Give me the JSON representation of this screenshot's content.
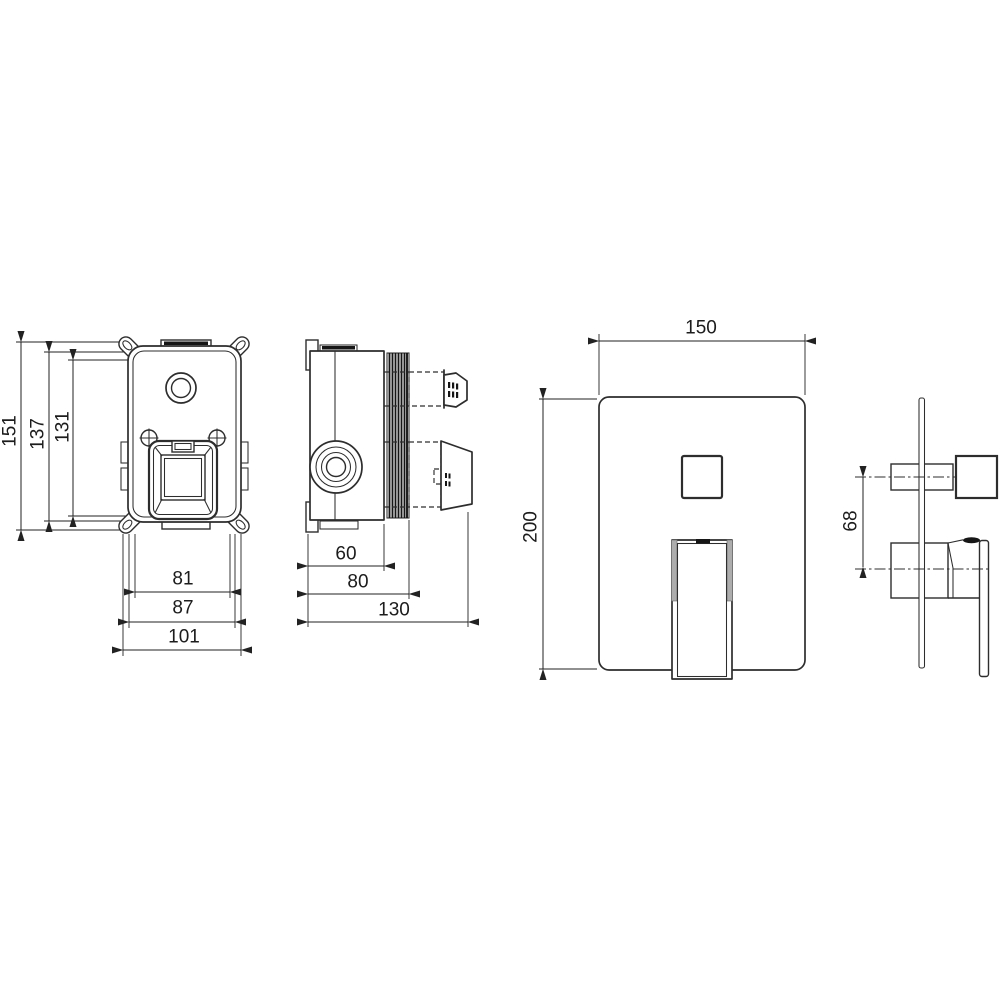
{
  "drawing": {
    "kind": "technical-dimension-drawing",
    "subject": "concealed shower mixer valve: rough-in box (front and side views) and trim plate with diverter button and lever handle (front and side views)"
  },
  "colors": {
    "background": "#ffffff",
    "line": "#2d2d2d",
    "dimension": "#222222",
    "dark_fill": "#161616",
    "handle_band_gray": "#adadad"
  },
  "dims": {
    "box_front": {
      "height_overall": "151",
      "height_fixing": "137",
      "height_body": "131",
      "width_inner": "81",
      "width_fixing": "87",
      "width_overall": "101"
    },
    "box_side": {
      "depth_front": "60",
      "depth_mid": "80",
      "depth_overall": "130"
    },
    "plate_front": {
      "width": "150",
      "height": "200"
    },
    "plate_side": {
      "control_spacing": "68"
    }
  }
}
